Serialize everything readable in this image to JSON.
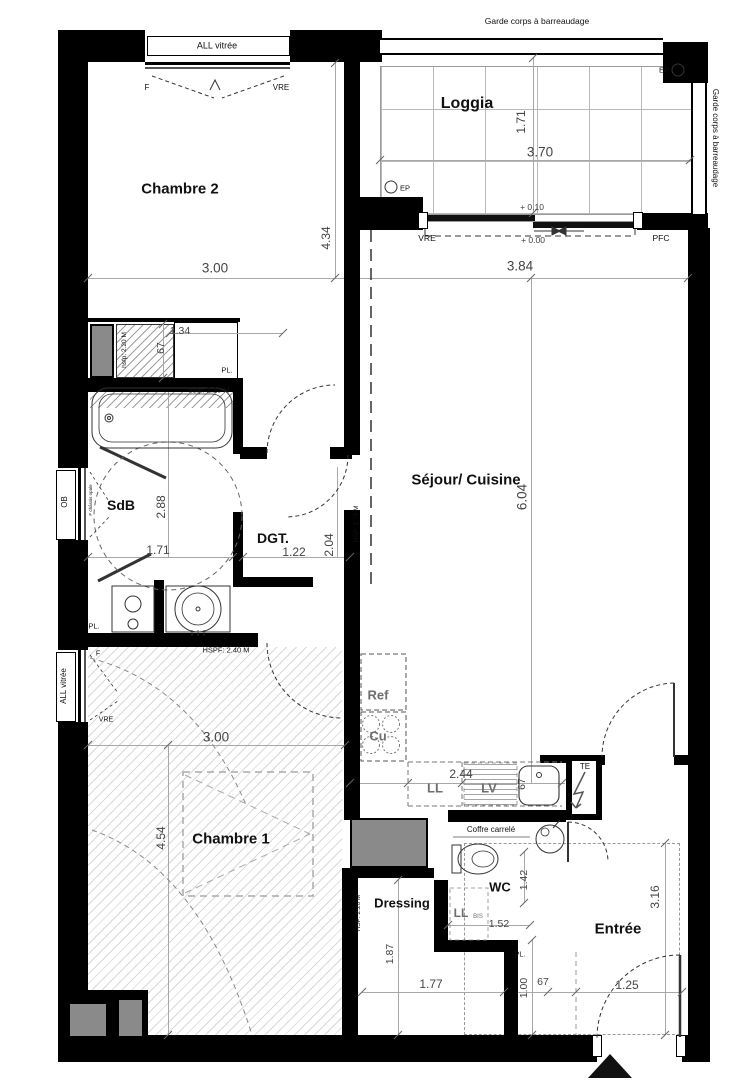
{
  "colors": {
    "wall": "#000000",
    "dim_text": "#444444",
    "chain_line": "#a8a8a8",
    "shaft_fill": "#8a8a8a",
    "appliance_text": "#6e6e6e"
  },
  "labels": [
    {
      "name": "garde-corps-top-label",
      "text": "Garde corps à barreaudage",
      "x": 537,
      "y": 21,
      "size": 8.5
    },
    {
      "name": "garde-corps-right-label",
      "text": "Garde corps à barreaudage",
      "x": 715,
      "y": 138,
      "rot": 90,
      "size": 8
    },
    {
      "name": "window-label-ch2",
      "text": "ALL vitrée",
      "x": 217,
      "y": 46,
      "size": 9
    },
    {
      "name": "window-f-ch2",
      "text": "F",
      "x": 147,
      "y": 88,
      "size": 8
    },
    {
      "name": "window-vre-ch2",
      "text": "VRE",
      "x": 281,
      "y": 88,
      "size": 8
    },
    {
      "name": "room-label-chambre2",
      "text": "Chambre 2",
      "x": 180,
      "y": 189,
      "size": 15,
      "bold": true
    },
    {
      "name": "room-label-loggia",
      "text": "Loggia",
      "x": 467,
      "y": 104,
      "size": 16,
      "bold": true
    },
    {
      "name": "ep-top-label",
      "text": "EP",
      "x": 664,
      "y": 70,
      "size": 7.5
    },
    {
      "name": "ep-bottom-label",
      "text": "EP",
      "x": 405,
      "y": 188,
      "size": 7.5
    },
    {
      "name": "dim-loggia-depth",
      "text": "1.71",
      "x": 521,
      "y": 122,
      "rot": -90,
      "size": 12,
      "color": "dim"
    },
    {
      "name": "dim-loggia-width",
      "text": "3.70",
      "x": 540,
      "y": 152,
      "size": 13.5,
      "color": "dim"
    },
    {
      "name": "level-plus-010",
      "text": "+ 0.10",
      "x": 532,
      "y": 207,
      "size": 8.5,
      "color": "dim"
    },
    {
      "name": "slider-vre-label",
      "text": "VRE",
      "x": 427,
      "y": 238,
      "size": 8.5
    },
    {
      "name": "level-plus-000",
      "text": "+ 0.00",
      "x": 533,
      "y": 240,
      "size": 8.5,
      "color": "dim"
    },
    {
      "name": "slider-pfc-label",
      "text": "PFC",
      "x": 661,
      "y": 238,
      "size": 8.5
    },
    {
      "name": "dim-ch2-width",
      "text": "3.00",
      "x": 215,
      "y": 268,
      "size": 13.5,
      "color": "dim"
    },
    {
      "name": "dim-ch2-height",
      "text": "4.34",
      "x": 326,
      "y": 238,
      "rot": -90,
      "size": 12,
      "color": "dim"
    },
    {
      "name": "dim-sejour-width",
      "text": "3.84",
      "x": 520,
      "y": 266,
      "size": 13.5,
      "color": "dim"
    },
    {
      "name": "dim-sejour-height",
      "text": "6.04",
      "x": 522,
      "y": 497,
      "rot": -90,
      "size": 13.5,
      "color": "dim"
    },
    {
      "name": "room-label-sejour",
      "text": "Séjour/ Cuisine",
      "x": 466,
      "y": 480,
      "size": 15,
      "bold": true
    },
    {
      "name": "note-hsp-270",
      "text": "HSP: 2.70 M",
      "x": 357,
      "y": 524,
      "rot": -90,
      "size": 6.5
    },
    {
      "name": "note-hsfp-220-closet",
      "text": "hsfp: 2.20 M",
      "x": 125,
      "y": 350,
      "rot": -90,
      "size": 6.5
    },
    {
      "name": "dim-closet-134",
      "text": "1.34",
      "x": 180,
      "y": 331,
      "size": 10.5,
      "color": "dim"
    },
    {
      "name": "dim-closet-67",
      "text": "67",
      "x": 161,
      "y": 348,
      "rot": -90,
      "size": 10.5,
      "color": "dim"
    },
    {
      "name": "closet-pl-label",
      "text": "PL.",
      "x": 227,
      "y": 370,
      "size": 7.5
    },
    {
      "name": "note-hsfp-220-tub",
      "text": "hsfp: 2.20 M",
      "x": 209,
      "y": 390,
      "size": 7.5
    },
    {
      "name": "window-ob-label",
      "text": "OB",
      "x": 65,
      "y": 502,
      "rot": -90,
      "size": 8
    },
    {
      "name": "window-sdb-note",
      "text": "F châssis opale",
      "x": 91,
      "y": 500,
      "rot": -90,
      "size": 4.5
    },
    {
      "name": "room-label-sdb",
      "text": "SdB",
      "x": 121,
      "y": 505,
      "size": 14,
      "bold": true
    },
    {
      "name": "dim-sdb-height",
      "text": "2.88",
      "x": 161,
      "y": 507,
      "rot": -90,
      "size": 12,
      "color": "dim"
    },
    {
      "name": "dim-sdb-width",
      "text": "1.71",
      "x": 158,
      "y": 550,
      "size": 12,
      "color": "dim"
    },
    {
      "name": "room-label-dgt",
      "text": "DGT.",
      "x": 273,
      "y": 538,
      "size": 14,
      "bold": true
    },
    {
      "name": "dim-dgt-width",
      "text": "1.22",
      "x": 294,
      "y": 552,
      "size": 12,
      "color": "dim"
    },
    {
      "name": "dim-dgt-height",
      "text": "2.04",
      "x": 329,
      "y": 545,
      "rot": -90,
      "size": 12,
      "color": "dim"
    },
    {
      "name": "sdb-pl-label",
      "text": "PL.",
      "x": 94,
      "y": 626,
      "size": 7.5
    },
    {
      "name": "kitchen-ref-label",
      "text": "Ref",
      "x": 378,
      "y": 695,
      "size": 13,
      "bold": true,
      "color": "app"
    },
    {
      "name": "kitchen-cu-label",
      "text": "Cu",
      "x": 378,
      "y": 736,
      "size": 13,
      "bold": true,
      "color": "app"
    },
    {
      "name": "kitchen-ll-label",
      "text": "LL",
      "x": 435,
      "y": 788,
      "size": 13,
      "bold": true,
      "color": "app"
    },
    {
      "name": "kitchen-lv-label",
      "text": "LV",
      "x": 489,
      "y": 788,
      "size": 13,
      "bold": true,
      "color": "app"
    },
    {
      "name": "dim-kitchen-244",
      "text": "2.44",
      "x": 461,
      "y": 774,
      "size": 12,
      "color": "dim"
    },
    {
      "name": "dim-sink-67",
      "text": "67",
      "x": 522,
      "y": 784,
      "rot": -90,
      "size": 10.5,
      "color": "dim"
    },
    {
      "name": "te-label",
      "text": "TE",
      "x": 585,
      "y": 767,
      "size": 8
    },
    {
      "name": "coffre-label",
      "text": "Coffre carrelé",
      "x": 491,
      "y": 830,
      "size": 8
    },
    {
      "name": "room-label-wc",
      "text": "WC",
      "x": 500,
      "y": 887,
      "size": 13,
      "bold": true
    },
    {
      "name": "dim-wc-142",
      "text": "1.42",
      "x": 524,
      "y": 880,
      "rot": -90,
      "size": 10.5,
      "color": "dim"
    },
    {
      "name": "wc-llbis-label",
      "text": "LL",
      "x": 461,
      "y": 913,
      "size": 12,
      "bold": true,
      "color": "app"
    },
    {
      "name": "wc-llbis-sub",
      "text": "BIS",
      "x": 478,
      "y": 917,
      "size": 6,
      "color": "app"
    },
    {
      "name": "dim-wc-152",
      "text": "1.52",
      "x": 499,
      "y": 924,
      "size": 10.5,
      "color": "dim"
    },
    {
      "name": "room-label-entree",
      "text": "Entrée",
      "x": 618,
      "y": 929,
      "size": 15,
      "bold": true
    },
    {
      "name": "dim-entree-316",
      "text": "3.16",
      "x": 655,
      "y": 897,
      "rot": -90,
      "size": 12,
      "color": "dim"
    },
    {
      "name": "dim-door-125",
      "text": "1.25",
      "x": 627,
      "y": 985,
      "size": 12,
      "color": "dim"
    },
    {
      "name": "wc-pl-label",
      "text": "PL.",
      "x": 520,
      "y": 955,
      "size": 7
    },
    {
      "name": "dim-pl-100",
      "text": "1.00",
      "x": 524,
      "y": 988,
      "rot": -90,
      "size": 10.5,
      "color": "dim"
    },
    {
      "name": "dim-pl-67",
      "text": "67",
      "x": 543,
      "y": 982,
      "size": 10.5,
      "color": "dim"
    },
    {
      "name": "dim-dressing-177",
      "text": "1.77",
      "x": 431,
      "y": 984,
      "size": 12,
      "color": "dim"
    },
    {
      "name": "room-label-dressing",
      "text": "Dressing",
      "x": 402,
      "y": 903,
      "size": 13,
      "bold": true
    },
    {
      "name": "note-hsp-220-dressing",
      "text": "HSP: 2.20 M",
      "x": 359,
      "y": 913,
      "rot": -90,
      "size": 6.5
    },
    {
      "name": "dim-dressing-187",
      "text": "1.87",
      "x": 390,
      "y": 954,
      "rot": -90,
      "size": 10.5,
      "color": "dim"
    },
    {
      "name": "room-label-chambre1",
      "text": "Chambre 1",
      "x": 231,
      "y": 839,
      "size": 15,
      "bold": true
    },
    {
      "name": "dim-ch1-width",
      "text": "3.00",
      "x": 216,
      "y": 737,
      "size": 13.5,
      "color": "dim"
    },
    {
      "name": "dim-ch1-height",
      "text": "4.54",
      "x": 161,
      "y": 838,
      "rot": -90,
      "size": 12,
      "color": "dim"
    },
    {
      "name": "note-hspf-240",
      "text": "HSPF: 2.40 M",
      "x": 226,
      "y": 650,
      "size": 7.5
    },
    {
      "name": "window-label-ch1",
      "text": "ALL vitrée",
      "x": 64,
      "y": 686,
      "rot": -90,
      "size": 8
    },
    {
      "name": "window-f-ch1",
      "text": "F",
      "x": 98,
      "y": 654,
      "size": 7
    },
    {
      "name": "window-vre-ch1",
      "text": "VRE",
      "x": 106,
      "y": 720,
      "size": 7
    }
  ]
}
